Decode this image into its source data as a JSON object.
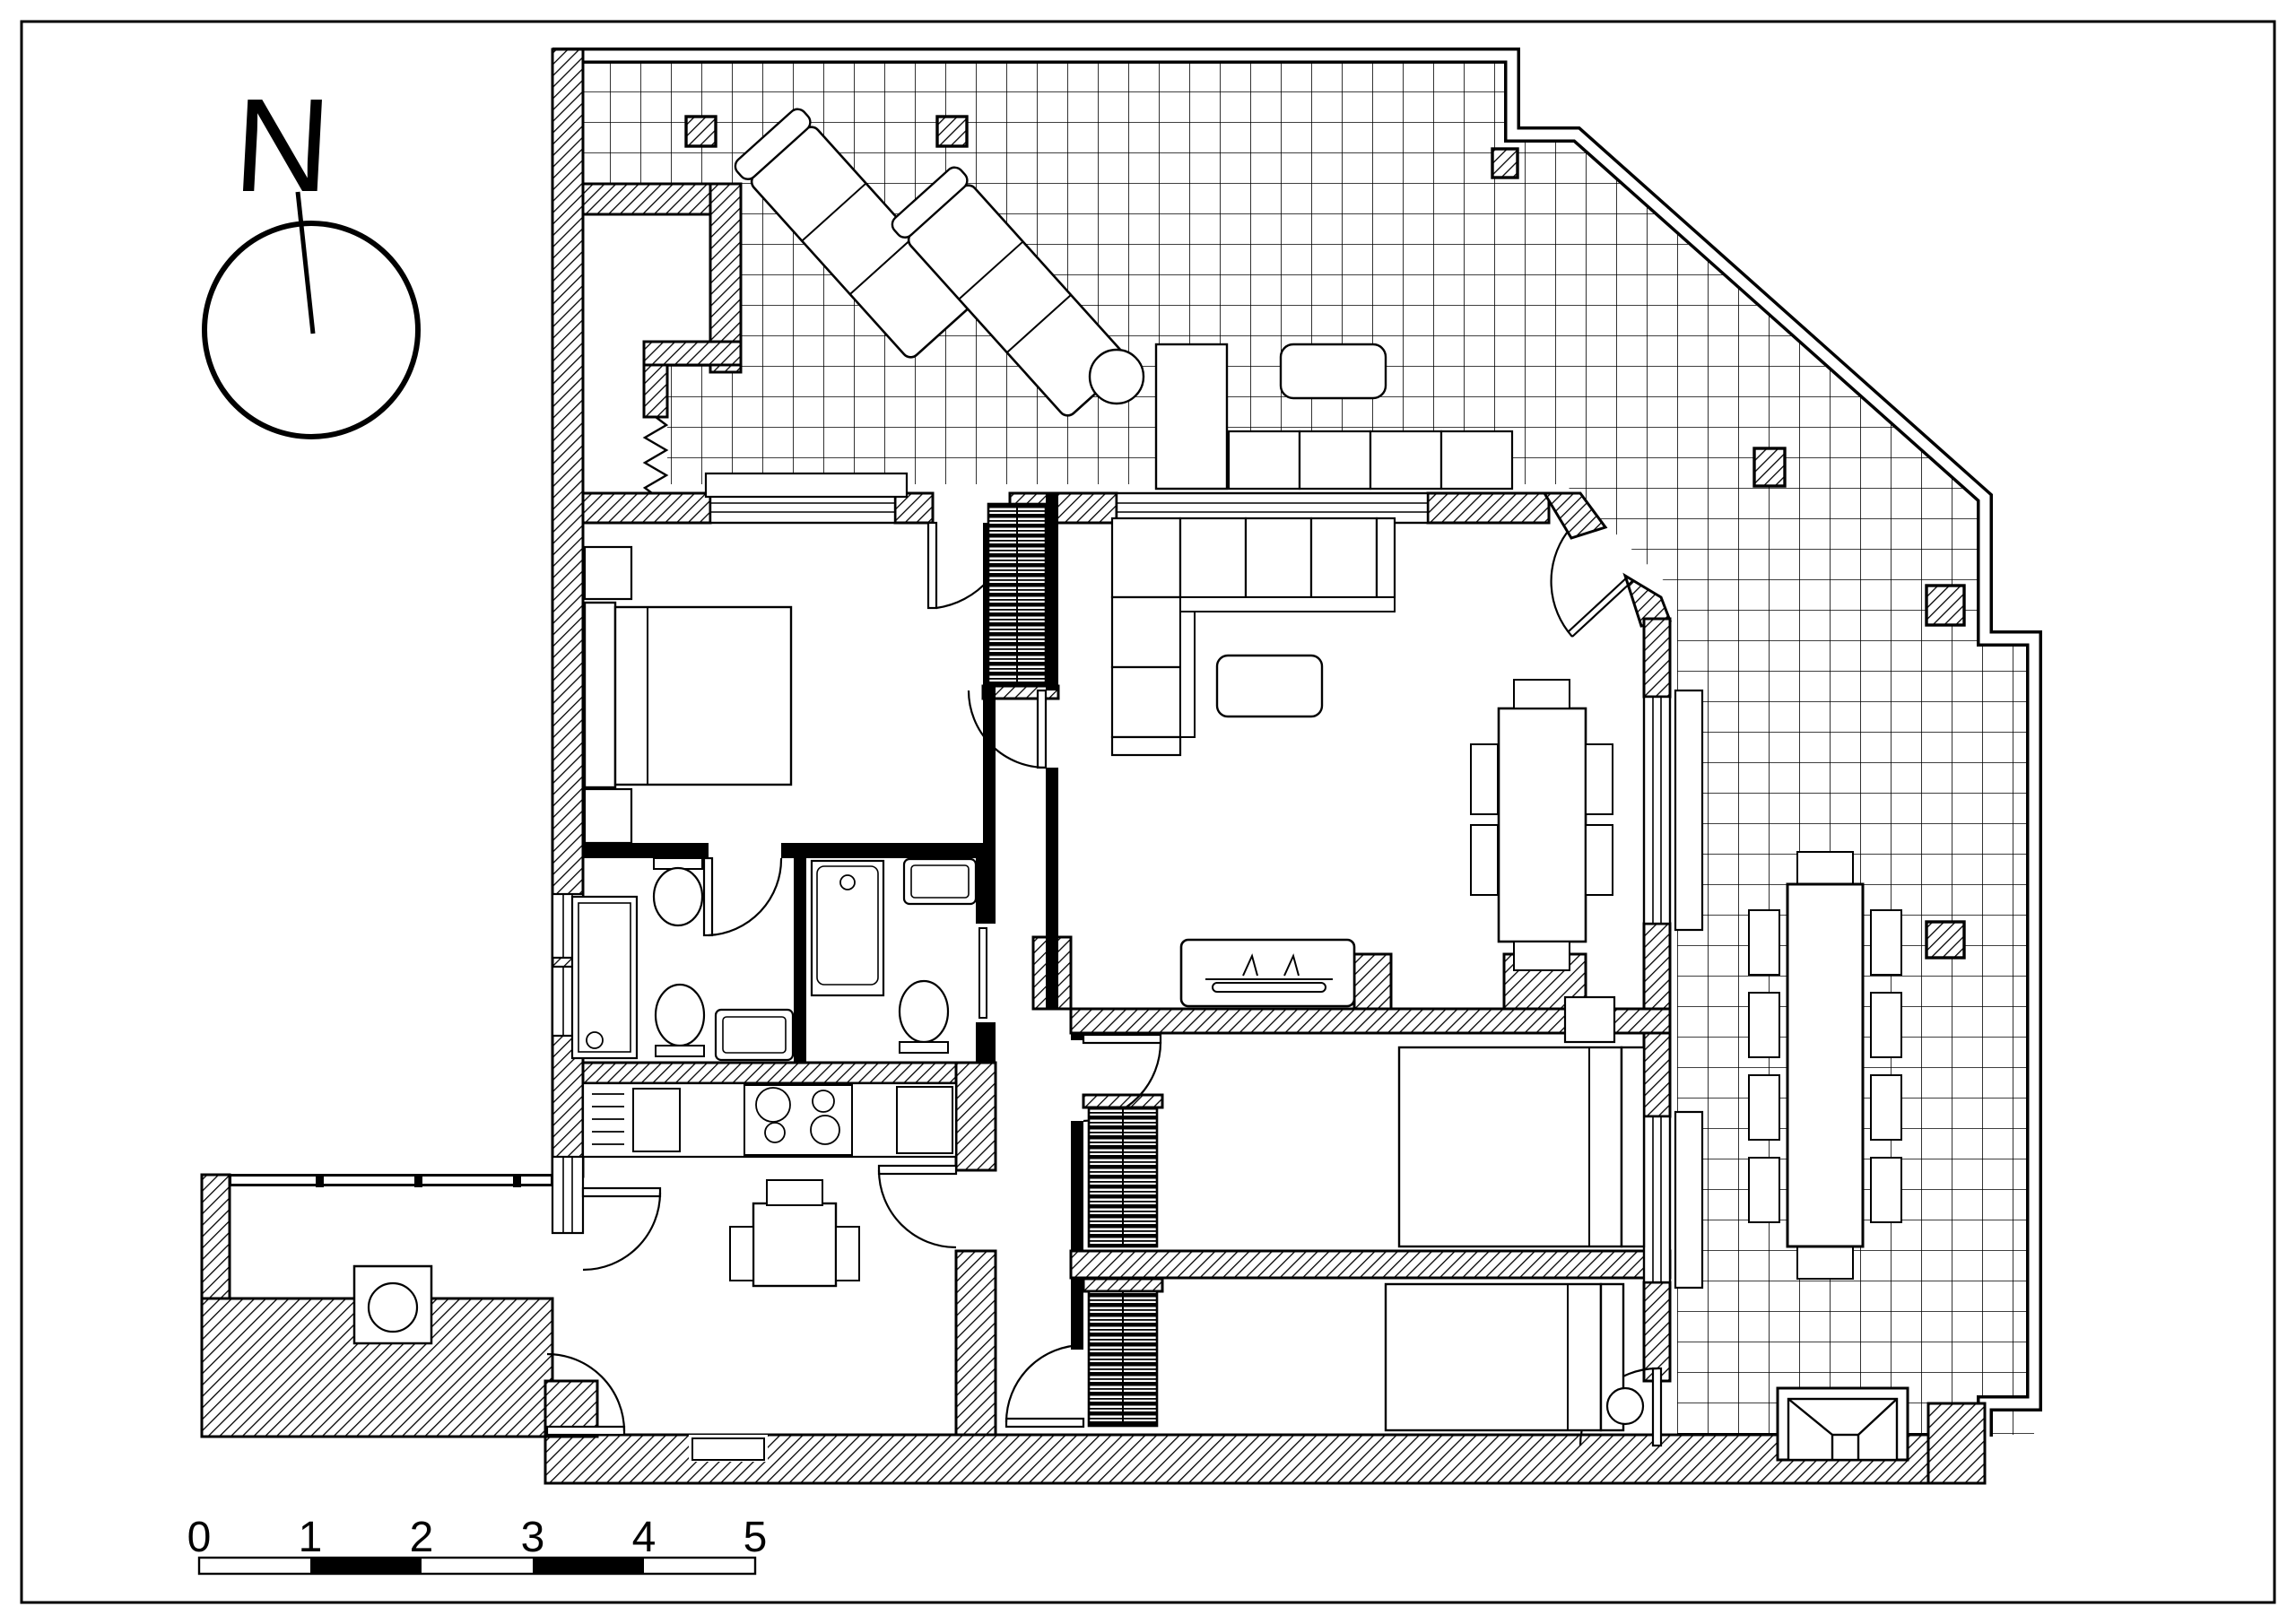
{
  "page": {
    "background": "#ffffff",
    "ink": "#000000",
    "type_of_drawing": "apartment floor plan with terrace"
  },
  "compass": {
    "label": "N"
  },
  "scale_bar": {
    "labels": [
      "0",
      "1",
      "2",
      "3",
      "4",
      "5"
    ]
  }
}
